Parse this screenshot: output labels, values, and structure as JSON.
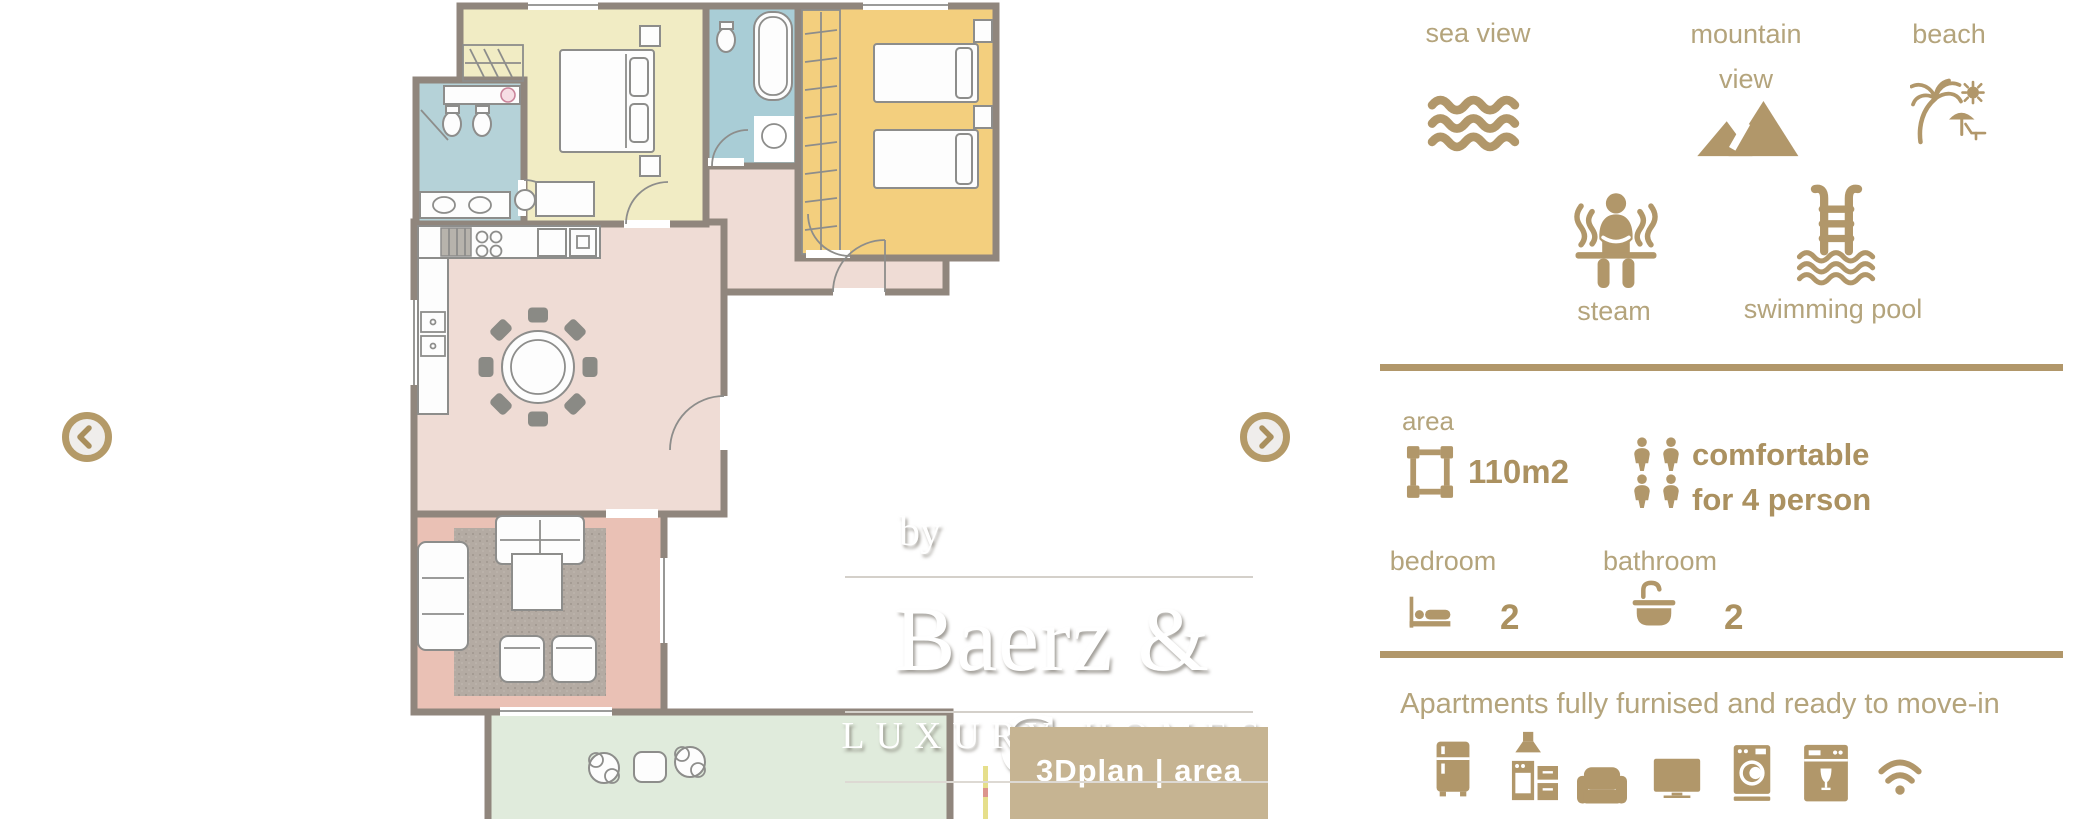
{
  "palette": {
    "gold": "#b1976a",
    "gold_text_bold": "#ab9160",
    "gold_label": "#b4a47c",
    "watermark_box": "#c6b492"
  },
  "watermark": {
    "by": "by",
    "brand": "Baerz & Co",
    "tagline": "LUXURY HOMES",
    "badge": "3Dplan | area"
  },
  "features": [
    {
      "label": "sea view",
      "icon": "waves-icon"
    },
    {
      "label": "mountain view",
      "icon": "mountains-icon"
    },
    {
      "label": "beach",
      "icon": "beach-icon"
    },
    {
      "label": "steam",
      "icon": "steam-icon"
    },
    {
      "label": "swimming pool",
      "icon": "pool-ladder-icon"
    }
  ],
  "stats": {
    "area": {
      "label": "area",
      "value": "110m2"
    },
    "capacity": {
      "line1": "comfortable",
      "line2": "for 4 person"
    },
    "bedroom": {
      "label": "bedroom",
      "count": "2"
    },
    "bathroom": {
      "label": "bathroom",
      "count": "2"
    }
  },
  "footer": {
    "note": "Apartments fully furnised and ready to move-in",
    "appliance_icons": [
      "fridge",
      "kitchen-stove",
      "sofa",
      "tv",
      "washing-machine",
      "dishwasher",
      "wifi"
    ]
  },
  "floorplan": {
    "colors": {
      "wall": "#90867d",
      "bedroom_master": "#f1ecc4",
      "bedroom_twin": "#f3cf7e",
      "bathroom_a": "#b5d2d8",
      "bathroom_b": "#a9cdd6",
      "dining": "#efdcd5",
      "living": "#eac1b5",
      "terrace": "#e0ebdc",
      "rug": "#b4aba3"
    }
  }
}
